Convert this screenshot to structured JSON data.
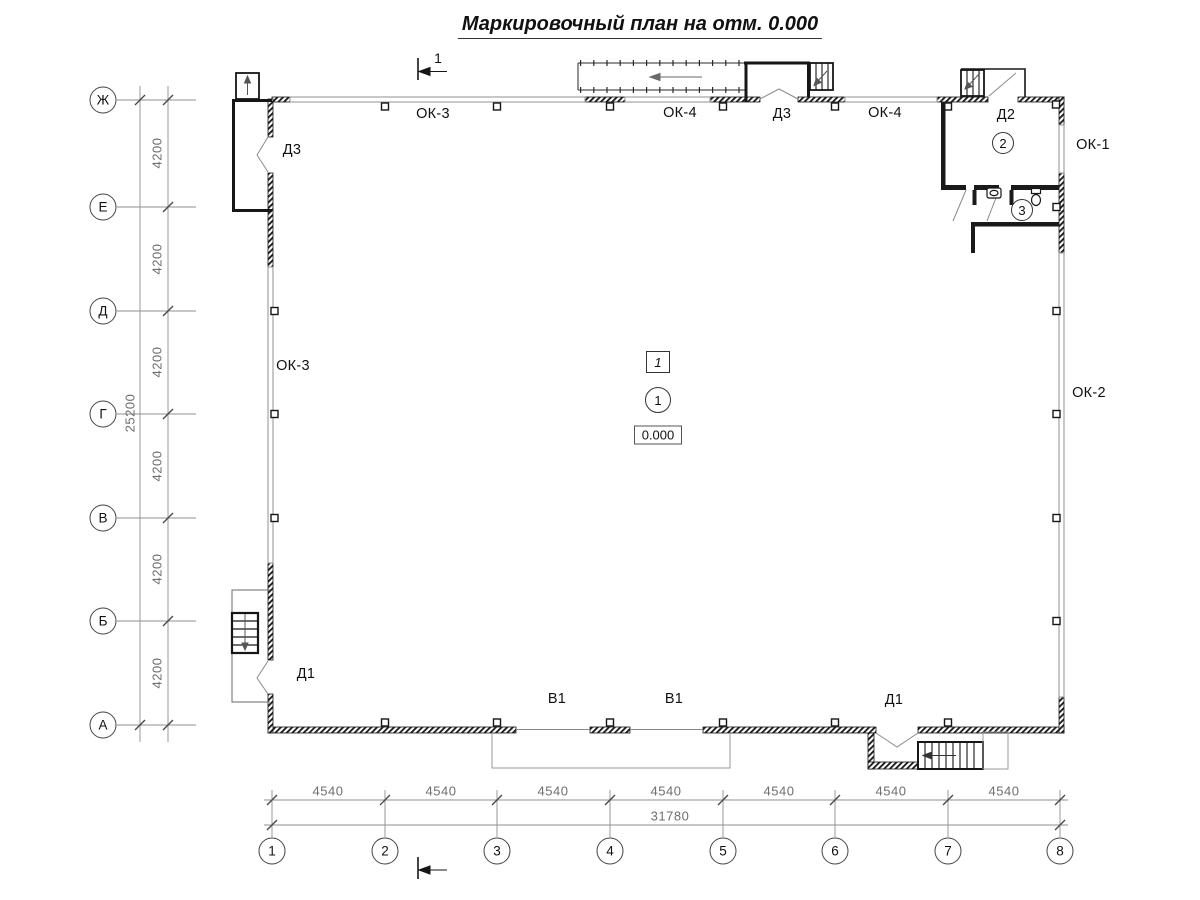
{
  "title": "Маркировочный план на отм. 0.000",
  "colors": {
    "line": "#1a1a1a",
    "window_line": "#9a9a9a",
    "dimension": "#6e6e6e",
    "background": "#ffffff"
  },
  "section": {
    "label": "1"
  },
  "axis_rows": [
    {
      "label": "Ж"
    },
    {
      "label": "Е"
    },
    {
      "label": "Д"
    },
    {
      "label": "Г"
    },
    {
      "label": "В"
    },
    {
      "label": "Б"
    },
    {
      "label": "А"
    }
  ],
  "axis_cols": [
    {
      "label": "1"
    },
    {
      "label": "2"
    },
    {
      "label": "3"
    },
    {
      "label": "4"
    },
    {
      "label": "5"
    },
    {
      "label": "6"
    },
    {
      "label": "7"
    },
    {
      "label": "8"
    }
  ],
  "dims": {
    "row_segments": [
      "4200",
      "4200",
      "4200",
      "4200",
      "4200",
      "4200"
    ],
    "row_total": "25200",
    "col_segments": [
      "4540",
      "4540",
      "4540",
      "4540",
      "4540",
      "4540",
      "4540"
    ],
    "col_total": "31780"
  },
  "marks": {
    "ok3_top": "ОК-3",
    "ok4_top_left": "ОК-4",
    "d3_top": "Д3",
    "ok4_top_right": "ОК-4",
    "d2": "Д2",
    "ok1": "ОК-1",
    "ok2": "ОК-2",
    "ok3_left": "ОК-3",
    "d3_left": "Д3",
    "d1_bottom_left": "Д1",
    "v1_left": "В1",
    "v1_right": "В1",
    "d1_bottom_right": "Д1"
  },
  "rooms": {
    "hall": "1",
    "entry": "2",
    "wc": "3"
  },
  "type_mark": "1",
  "elevation": "0.000"
}
